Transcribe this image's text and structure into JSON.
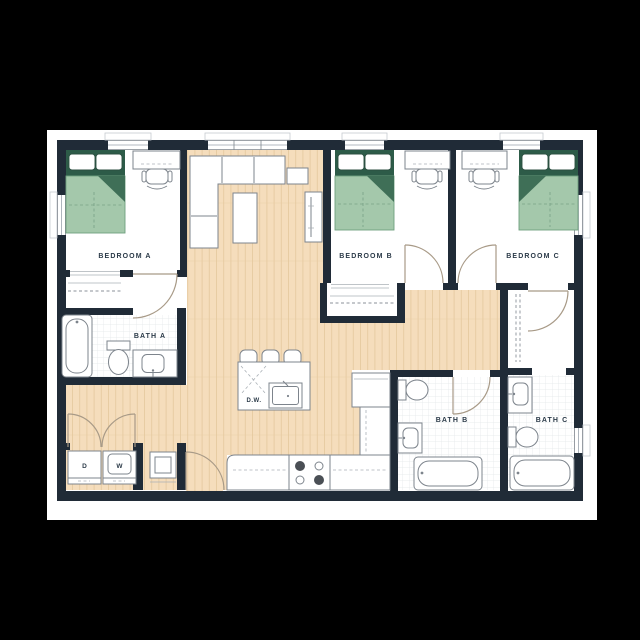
{
  "plan": {
    "rooms": {
      "bedroom_a": {
        "label": "BEDROOM A"
      },
      "bedroom_b": {
        "label": "BEDROOM B"
      },
      "bedroom_c": {
        "label": "BEDROOM C"
      },
      "bath_a": {
        "label": "BATH A"
      },
      "bath_b": {
        "label": "BATH B"
      },
      "bath_c": {
        "label": "BATH C"
      }
    },
    "kitchen": {
      "dishwasher_label": "D.W."
    },
    "laundry": {
      "dryer_label": "D",
      "washer_label": "W"
    }
  },
  "palette": {
    "background": "#000000",
    "page": "#ffffff",
    "wall": "#202b37",
    "wood": "#f5ddbc",
    "wood_line": "#e6caa0",
    "tile_line": "#e3e6e9",
    "stroke": "#7d848c",
    "door": "#a89a87",
    "green_dark": "#2d5b48",
    "green_mid": "#3f6f57",
    "green_light": "#a4c8ab",
    "label": "#2b3a48"
  }
}
